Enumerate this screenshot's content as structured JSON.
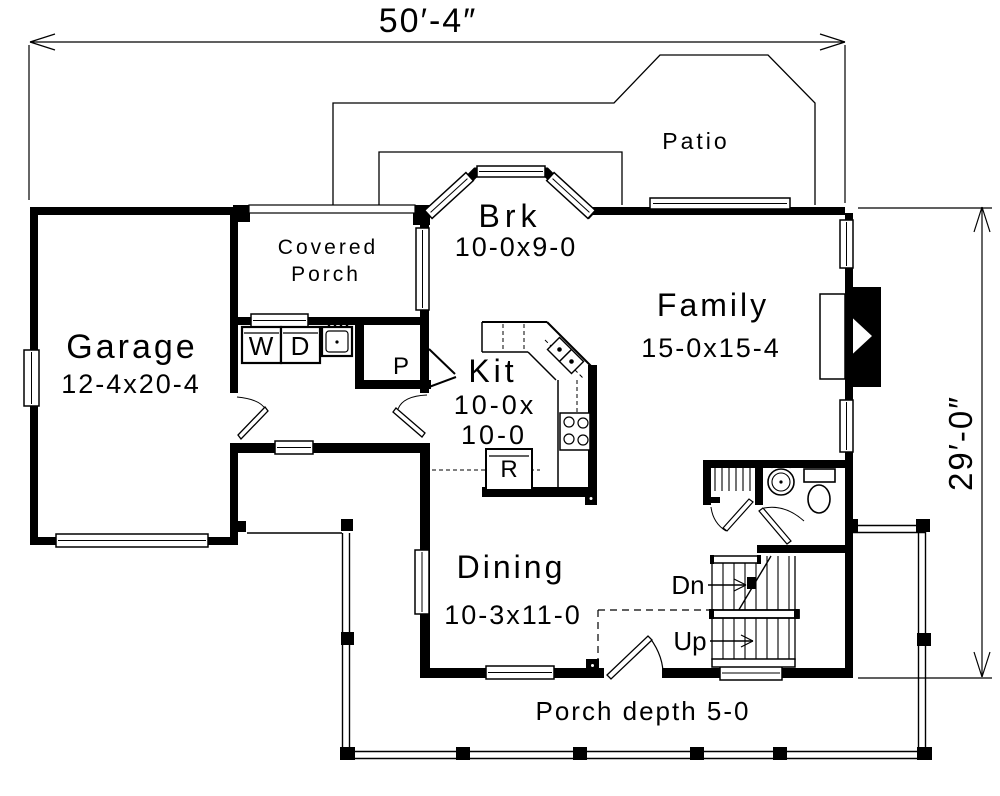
{
  "labels": {
    "dim_top": "50′-4″",
    "dim_right": "29′-0″",
    "patio": "Patio",
    "brk_name": "Brk",
    "brk_size": "10-0x9-0",
    "covered_porch_1": "Covered",
    "covered_porch_2": "Porch",
    "family_name": "Family",
    "family_size": "15-0x15-4",
    "garage_name": "Garage",
    "garage_size": "12-4x20-4",
    "kit_name": "Kit",
    "kit_size_1": "10-0x",
    "kit_size_2": "10-0",
    "dining_name": "Dining",
    "dining_size": "10-3x11-0",
    "washer": "W",
    "dryer": "D",
    "pantry": "P",
    "fridge": "R",
    "stair_down": "Dn",
    "stair_up": "Up",
    "porch_depth": "Porch depth 5-0"
  },
  "colors": {
    "ink": "#000000",
    "paper": "#ffffff"
  }
}
